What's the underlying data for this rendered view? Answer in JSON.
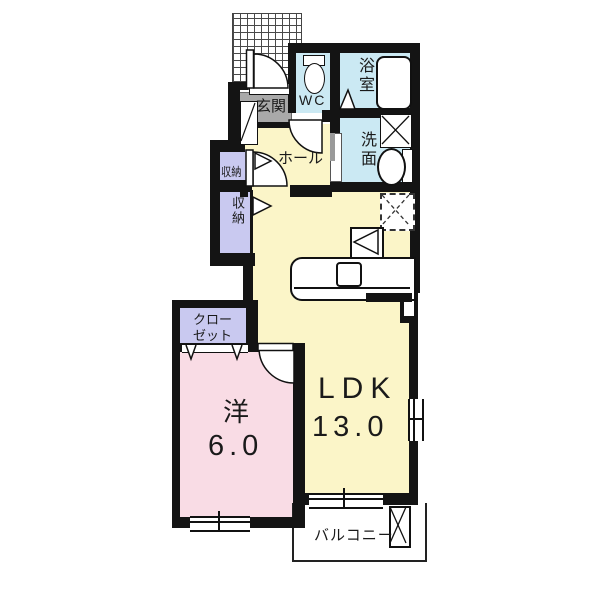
{
  "title": "apartment-floorplan",
  "colors": {
    "wall": "#141414",
    "room_yellow": "#FBF5C8",
    "room_pink": "#F9DCE5",
    "room_blue": "#CBE9F3",
    "room_purple": "#C9C9F0",
    "entrance_gray": "#A9A9A9"
  },
  "rooms": {
    "entrance": {
      "label": "玄関"
    },
    "wc": {
      "label": "WC"
    },
    "bathroom": {
      "label": "浴室"
    },
    "washroom": {
      "label": "洗面"
    },
    "hall": {
      "label": "ホール"
    },
    "storage_upper": {
      "label": "収納"
    },
    "storage_lower": {
      "label": "収納"
    },
    "closet": {
      "label_line1": "クロー",
      "label_line2": "ゼット"
    },
    "western_room": {
      "label": "洋",
      "size": "6.0"
    },
    "ldk": {
      "label": "LDK",
      "size": "13.0"
    },
    "balcony": {
      "label": "バルコニー"
    }
  }
}
